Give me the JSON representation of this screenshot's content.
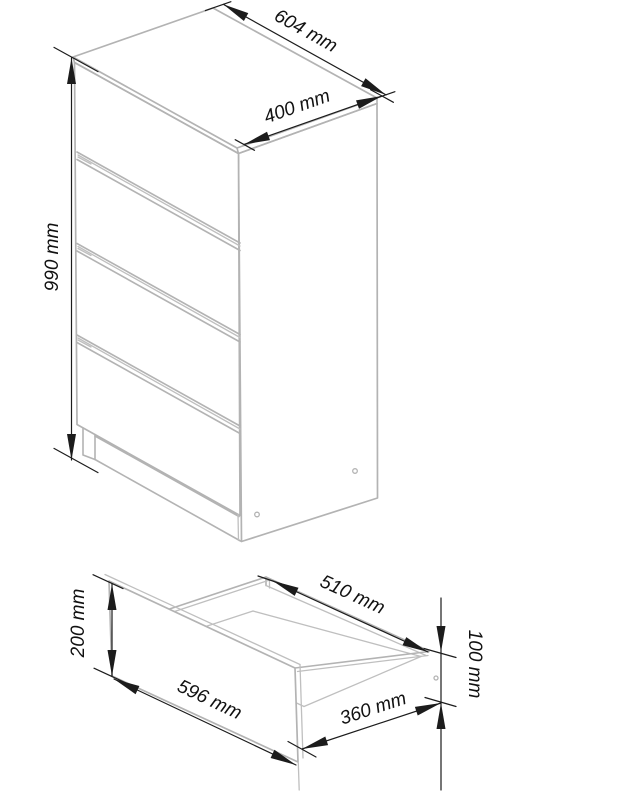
{
  "figure": {
    "kind": "furniture-dimension-diagram",
    "units": "mm",
    "background": "#ffffff",
    "views": {
      "chest": {
        "name": "chest-of-drawers-isometric",
        "drawer_count": 4,
        "dims": {
          "width": {
            "label": "604 mm",
            "value": 604
          },
          "depth": {
            "label": "400 mm",
            "value": 400
          },
          "height": {
            "label": "990 mm",
            "value": 990
          }
        }
      },
      "drawer": {
        "name": "single-drawer-isometric",
        "dims": {
          "front_width": {
            "label": "596 mm",
            "value": 596
          },
          "front_height": {
            "label": "200 mm",
            "value": 200
          },
          "depth": {
            "label": "510 mm",
            "value": 510
          },
          "inner_depth": {
            "label": "360 mm",
            "value": 360
          },
          "side_height": {
            "label": "100 mm",
            "value": 100
          }
        }
      }
    },
    "colors": {
      "body_line": "#b3b3b3",
      "dimension_line": "#1c1c1c",
      "text": "#111111"
    }
  }
}
